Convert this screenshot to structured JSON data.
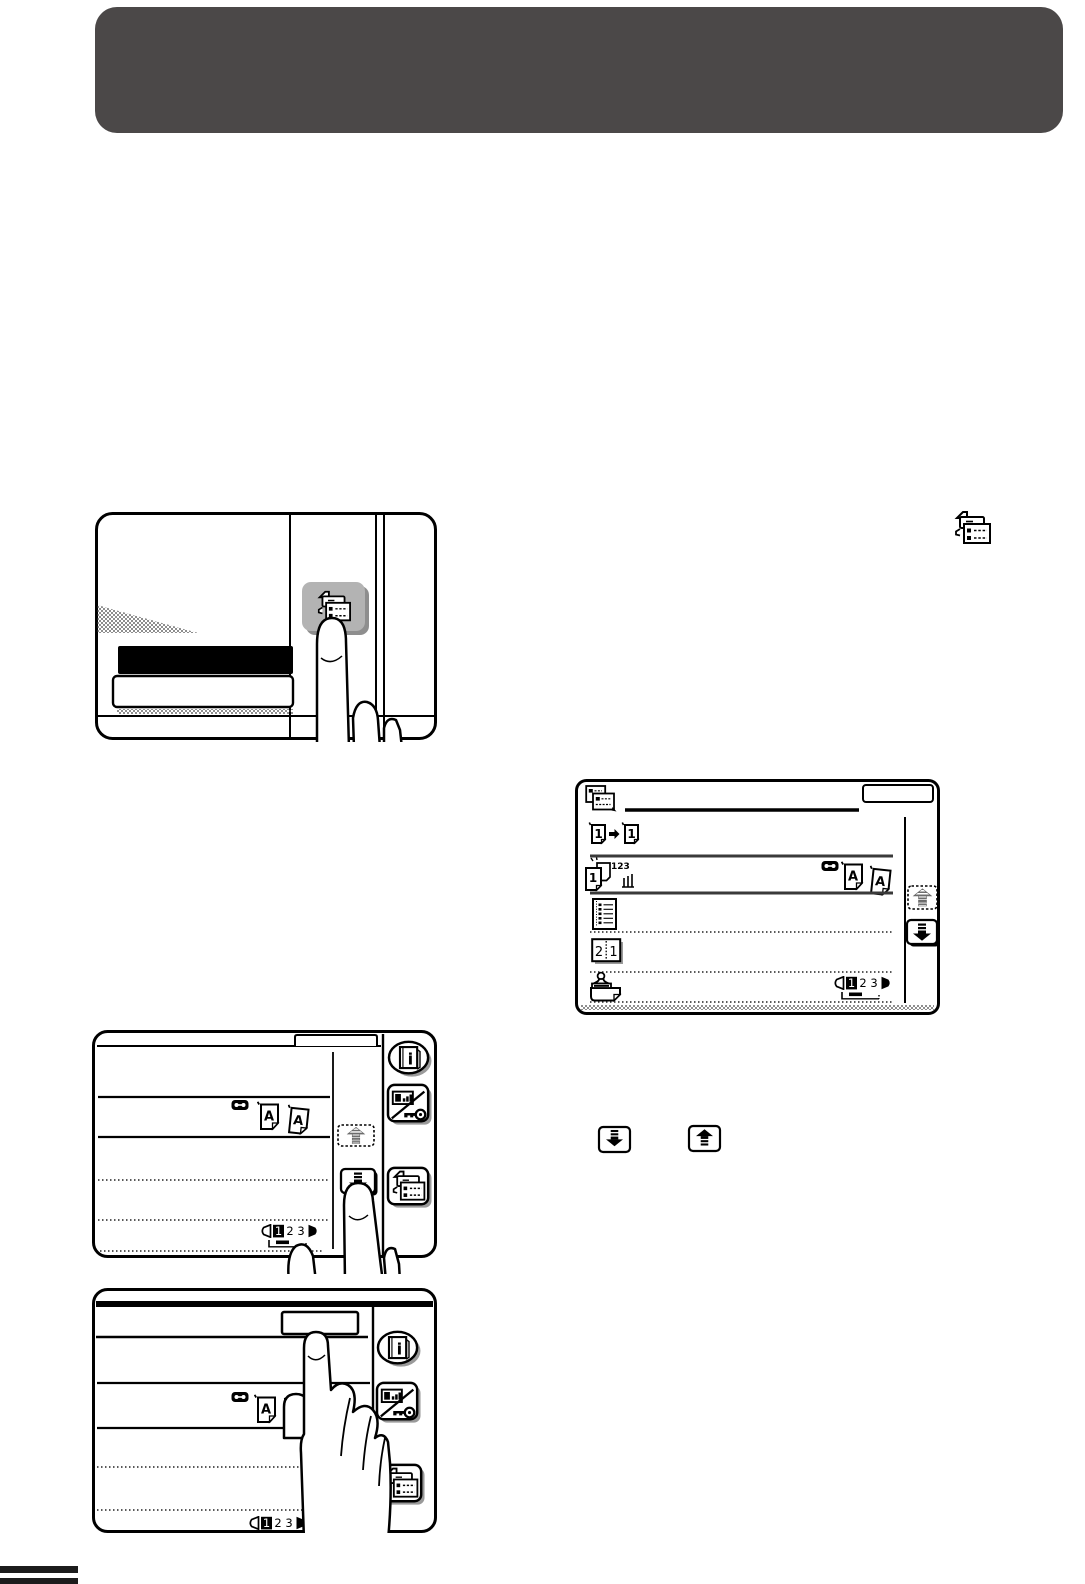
{
  "header": {
    "title": "",
    "bg_color": "#4b4848"
  },
  "colors": {
    "header_bg": "#4b4848",
    "ink": "#000000",
    "key_gray": "#b3b3b3",
    "shadow_gray": "#8e8e8e"
  },
  "panel": {
    "pressed_key": "job-status-key"
  },
  "screen": {
    "ok_key_label": "",
    "title_icon": "special-modes-icon",
    "menu_icons": {
      "copy_mode": {
        "icon": "one-to-one-copy-icon",
        "from_num": "1",
        "to_num": "1"
      },
      "sort": {
        "icon": "sort-copy-icon",
        "front_num": "1",
        "fly_nums": "123"
      },
      "original_type": {
        "icons": [
          "film-icon",
          "a-page-icon",
          "a-page-tilted-icon"
        ],
        "letter_a1": "A",
        "letter_a2": "A"
      },
      "document": {
        "icon": "document-list-icon"
      },
      "two_in_one": {
        "icon": "two-in-one-icon",
        "left_num": "2",
        "right_num": "1"
      },
      "stamp": {
        "icon": "stamp-icon"
      }
    },
    "pager": {
      "p1": "1",
      "p2": "2",
      "p3": "3",
      "active": "1"
    },
    "keys": {
      "info_glyph": "i",
      "scroll_up": "up-arrow-key",
      "scroll_down": "down-arrow-key",
      "contrast": "display-contrast-key",
      "job_status": "job-status-key"
    }
  }
}
